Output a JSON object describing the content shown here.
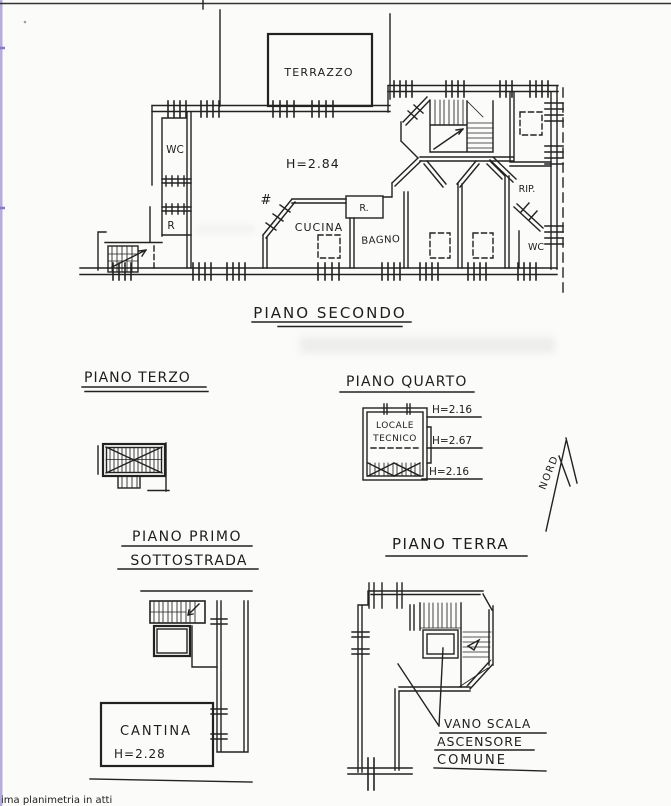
{
  "colors": {
    "ink": "#222222",
    "scan_edge_purple": "#b7abdf",
    "footer_ink": "#5b5b82",
    "paper": "#fbfbf9"
  },
  "footer": {
    "note": "ima planimetria in atti"
  },
  "compass": {
    "label": "NORD"
  },
  "floors": {
    "secondo": {
      "title": "PIANO SECONDO",
      "rooms": {
        "terrazzo": "TERRAZZO",
        "wc_left": "WC",
        "ripostiglio_left": "R",
        "cucina": "CUCINA",
        "ripostiglio_center": "R.",
        "bagno": "BAGNO",
        "ripostiglio_right": "RIP.",
        "wc_right": "WC"
      },
      "annotations": {
        "ceiling_height": "H=2.84",
        "window_mark": "#"
      }
    },
    "terzo": {
      "title": "PIANO TERZO"
    },
    "quarto": {
      "title": "PIANO QUARTO",
      "rooms": {
        "locale_tecnico_line1": "LOCALE",
        "locale_tecnico_line2": "TECNICO"
      },
      "annotations": {
        "height_top": "H=2.16",
        "height_mid": "H=2.67",
        "height_bottom": "H=2.16"
      }
    },
    "primo": {
      "title_line1": "PIANO PRIMO",
      "title_line2": "SOTTOSTRADA",
      "rooms": {
        "cantina": "CANTINA"
      },
      "annotations": {
        "ceiling_height": "H=2.28"
      }
    },
    "terra": {
      "title": "PIANO TERRA",
      "callout": {
        "line1": "VANO SCALA",
        "line2": "ASCENSORE",
        "line3": "COMUNE"
      }
    }
  }
}
